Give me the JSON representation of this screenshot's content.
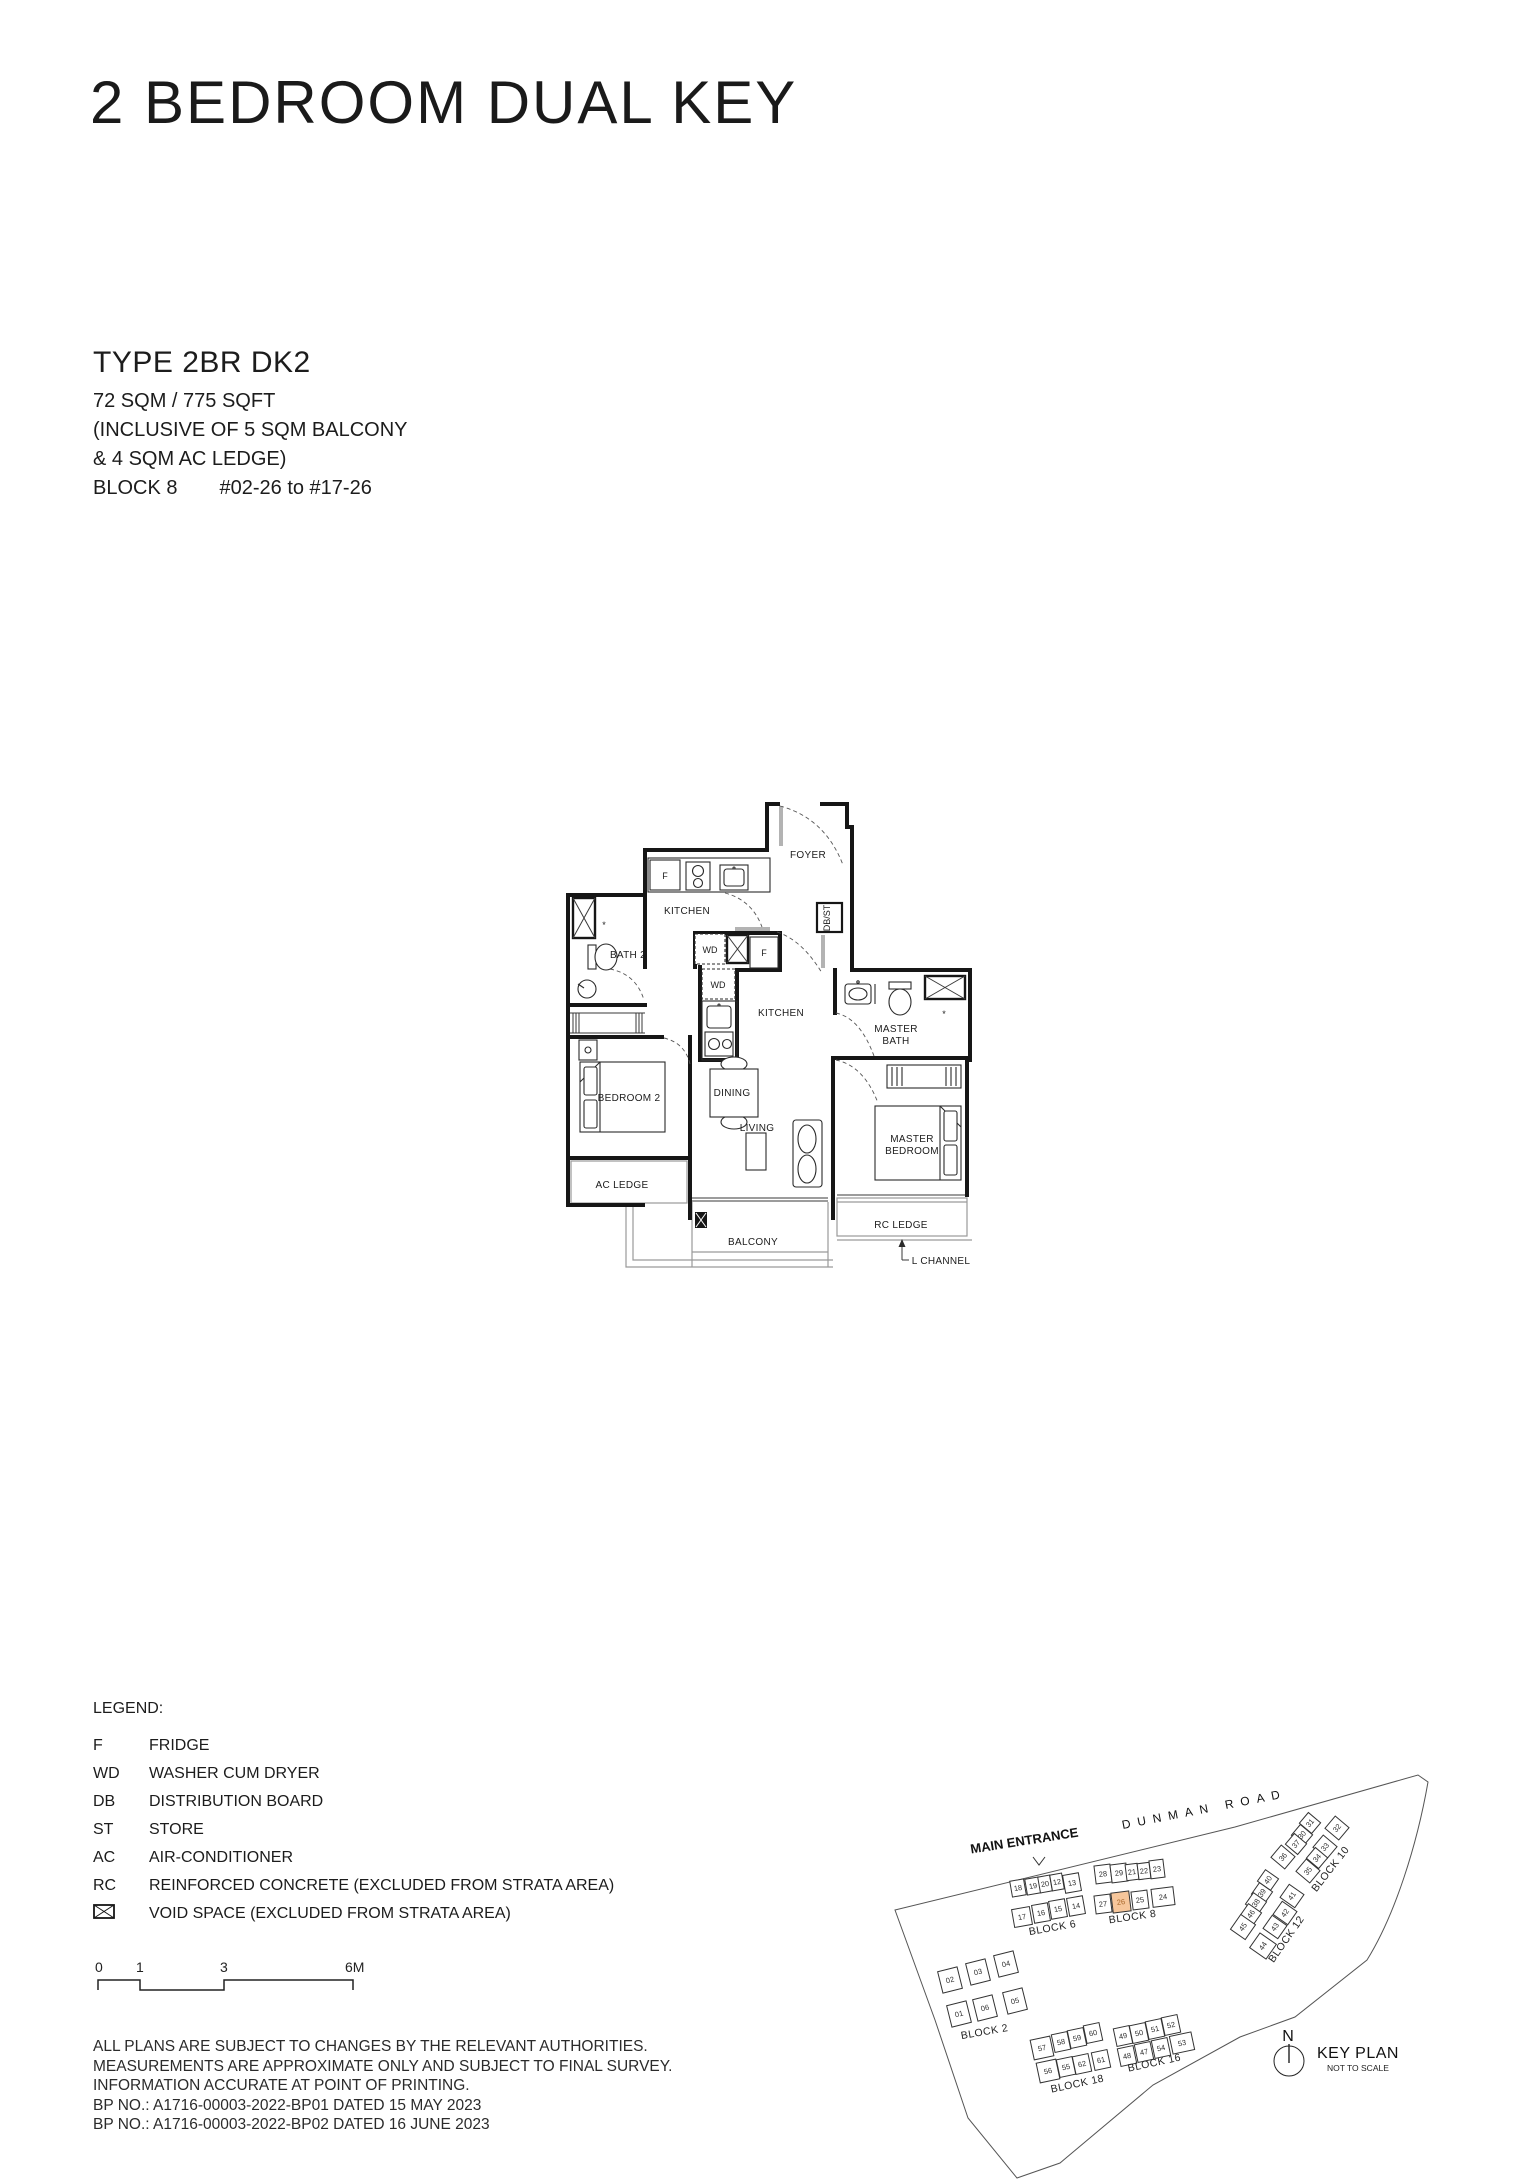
{
  "title": "2 BEDROOM DUAL KEY",
  "unit_info": {
    "type": "TYPE 2BR DK2",
    "area": "72 SQM / 775 SQFT",
    "inclusive1": "(INCLUSIVE OF 5 SQM BALCONY",
    "inclusive2": "& 4 SQM AC LEDGE)",
    "block": "BLOCK 8",
    "stack": "#02-26 to #17-26"
  },
  "floor_plan": {
    "labels": {
      "foyer": "FOYER",
      "kitchen_upper": "KITCHEN",
      "kitchen_main": "KITCHEN",
      "bath2": "BATH 2",
      "master_bath_1": "MASTER",
      "master_bath_2": "BATH",
      "bedroom2": "BEDROOM 2",
      "dining": "DINING",
      "living": "LIVING",
      "master_bed_1": "MASTER",
      "master_bed_2": "BEDROOM",
      "ac_ledge": "AC LEDGE",
      "balcony": "BALCONY",
      "rc_ledge": "RC LEDGE",
      "l_channel": "L CHANNEL",
      "fridge": "F",
      "washer": "WD",
      "db_store": "DB/ST",
      "ac_mark": "*"
    }
  },
  "legend": {
    "title": "LEGEND:",
    "items": [
      {
        "abbr": "F",
        "desc": "FRIDGE"
      },
      {
        "abbr": "WD",
        "desc": "WASHER CUM DRYER"
      },
      {
        "abbr": "DB",
        "desc": "DISTRIBUTION BOARD"
      },
      {
        "abbr": "ST",
        "desc": "STORE"
      },
      {
        "abbr": "AC",
        "desc": "AIR-CONDITIONER"
      },
      {
        "abbr": "RC",
        "desc": "REINFORCED CONCRETE (EXCLUDED FROM STRATA AREA)"
      },
      {
        "abbr": "",
        "desc": "VOID SPACE (EXCLUDED FROM STRATA AREA)",
        "symbol": "void-box"
      }
    ]
  },
  "scale": {
    "t0": "0",
    "t1": "1",
    "t3": "3",
    "t6": "6M"
  },
  "disclaimer": [
    "ALL PLANS ARE SUBJECT TO CHANGES BY THE RELEVANT AUTHORITIES.",
    "MEASUREMENTS ARE APPROXIMATE ONLY AND SUBJECT TO FINAL SURVEY.",
    "INFORMATION ACCURATE AT POINT OF PRINTING.",
    "BP NO.: A1716-00003-2022-BP01 DATED 15 MAY 2023",
    "BP NO.: A1716-00003-2022-BP02 DATED 16 JUNE 2023"
  ],
  "key_plan": {
    "main_entrance": "MAIN ENTRANCE",
    "road": "DUNMAN ROAD",
    "north": "N",
    "title": "KEY PLAN",
    "subtitle": "NOT TO SCALE",
    "highlighted_unit": "26",
    "highlight_color": "#f6c69b",
    "blocks": {
      "b6": {
        "label": "BLOCK 6",
        "units": [
          "18",
          "19",
          "20",
          "12",
          "13",
          "17",
          "16",
          "15",
          "14"
        ]
      },
      "b8": {
        "label": "BLOCK 8",
        "units": [
          "28",
          "29",
          "21",
          "22",
          "23",
          "27",
          "26",
          "25",
          "24"
        ]
      },
      "b10": {
        "label": "BLOCK 10",
        "units": [
          "31",
          "32",
          "30",
          "37",
          "33",
          "36",
          "34",
          "35"
        ]
      },
      "b12": {
        "label": "BLOCK 12",
        "units": [
          "40",
          "39",
          "41",
          "38",
          "42",
          "46",
          "43",
          "45",
          "44"
        ]
      },
      "b2": {
        "label": "BLOCK 2",
        "units": [
          "02",
          "03",
          "04",
          "01",
          "06",
          "05"
        ]
      },
      "b18": {
        "label": "BLOCK 18",
        "units": [
          "57",
          "58",
          "59",
          "60",
          "56",
          "55",
          "62",
          "61"
        ]
      },
      "b16": {
        "label": "BLOCK 16",
        "units": [
          "49",
          "50",
          "51",
          "52",
          "48",
          "47",
          "54",
          "53"
        ]
      }
    }
  }
}
